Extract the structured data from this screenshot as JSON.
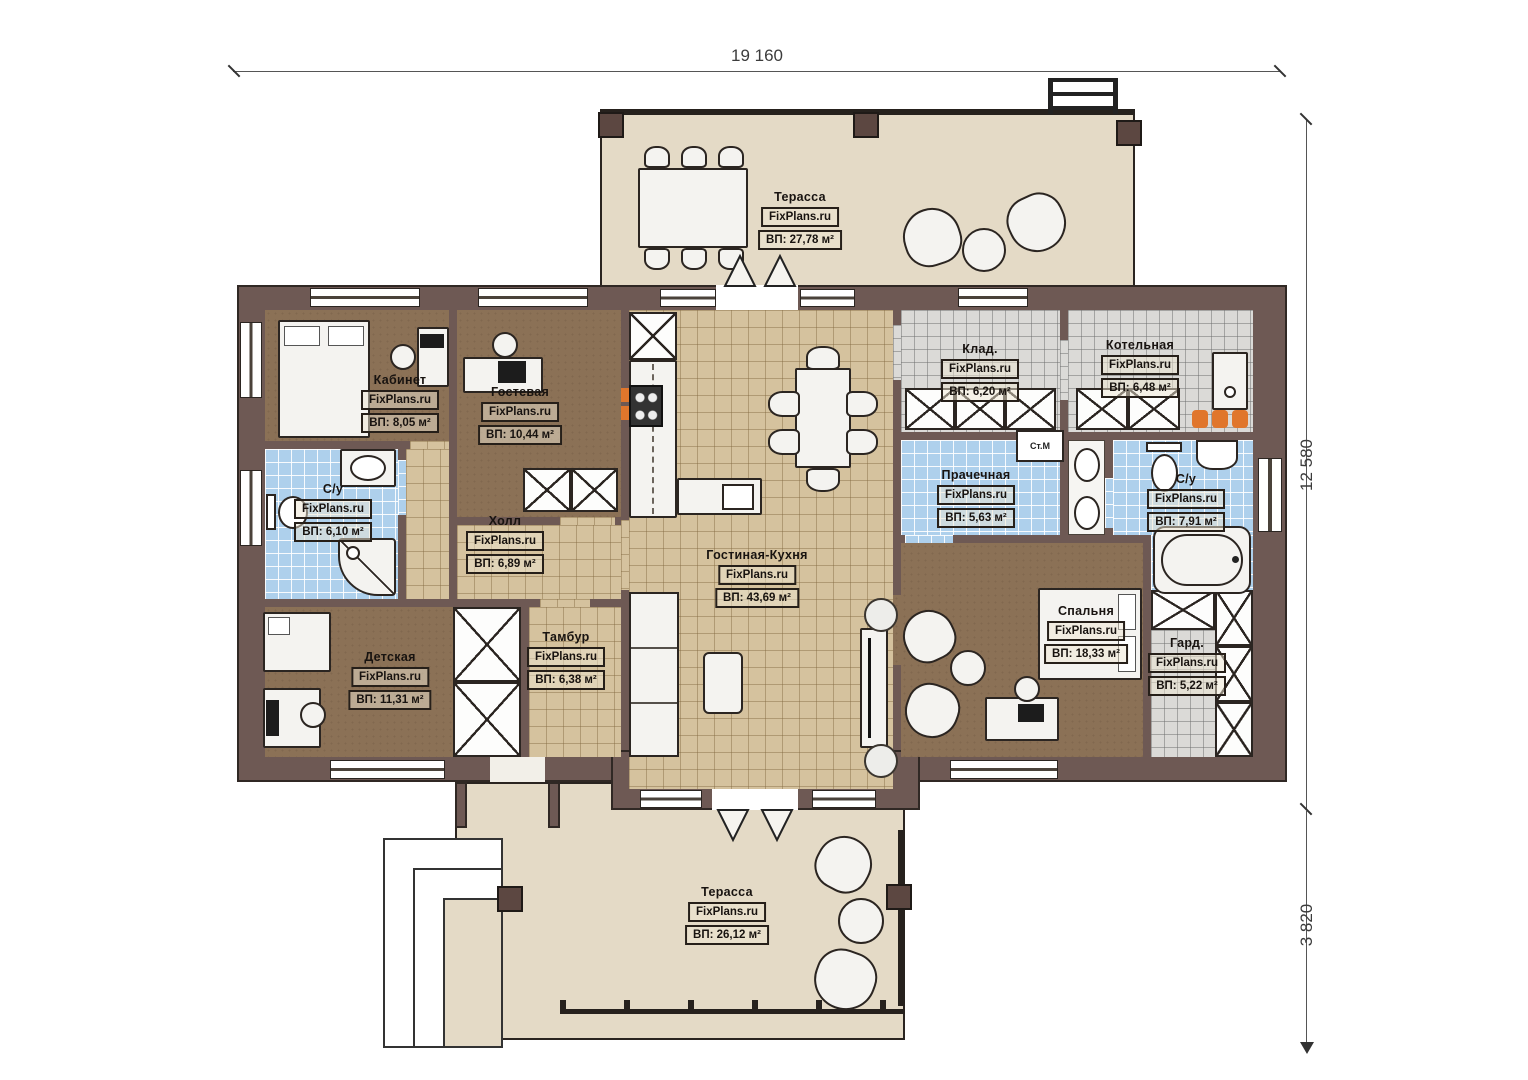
{
  "dimensions": {
    "width_total": "19 160",
    "height_total": "12 580",
    "terrace_depth": "3 820"
  },
  "brand": "FixPlans.ru",
  "rooms": {
    "terrace_top": {
      "name": "Терасса",
      "area": "ВП: 27,78 м²"
    },
    "kabinet": {
      "name": "Кабинет",
      "area": "ВП: 8,05 м²"
    },
    "gostevaya": {
      "name": "Гостевая",
      "area": "ВП: 10,44 м²"
    },
    "su_left": {
      "name": "С/у",
      "area": "ВП: 6,10 м²"
    },
    "hall": {
      "name": "Холл",
      "area": "ВП: 6,89 м²"
    },
    "detskaya": {
      "name": "Детская",
      "area": "ВП: 11,31 м²"
    },
    "tambur": {
      "name": "Тамбур",
      "area": "ВП: 6,38 м²"
    },
    "living": {
      "name": "Гостиная-Кухня",
      "area": "ВП: 43,69 м²"
    },
    "klad": {
      "name": "Клад.",
      "area": "ВП: 6,20 м²"
    },
    "kotelnaya": {
      "name": "Котельная",
      "area": "ВП: 6,48 м²"
    },
    "prachechnaya": {
      "name": "Прачечная",
      "area": "ВП: 5,63 м²"
    },
    "su_right": {
      "name": "С/у",
      "area": "ВП: 7,91 м²"
    },
    "spalnya": {
      "name": "Спальня",
      "area": "ВП: 18,33 м²"
    },
    "garderob": {
      "name": "Гард.",
      "area": "ВП: 5,22 м²"
    },
    "terrace_bottom": {
      "name": "Терасса",
      "area": "ВП: 26,12 м²"
    }
  },
  "appliances": {
    "washer": "Ст.М"
  },
  "colors": {
    "wall": "#6e5954",
    "floor_wood": "#8b7156",
    "floor_tile": "#d5c29e",
    "floor_bath": "#aed0ec",
    "floor_tech": "#dbdad7",
    "terrace": "#e4dac6",
    "accent_orange": "#e0762c"
  }
}
